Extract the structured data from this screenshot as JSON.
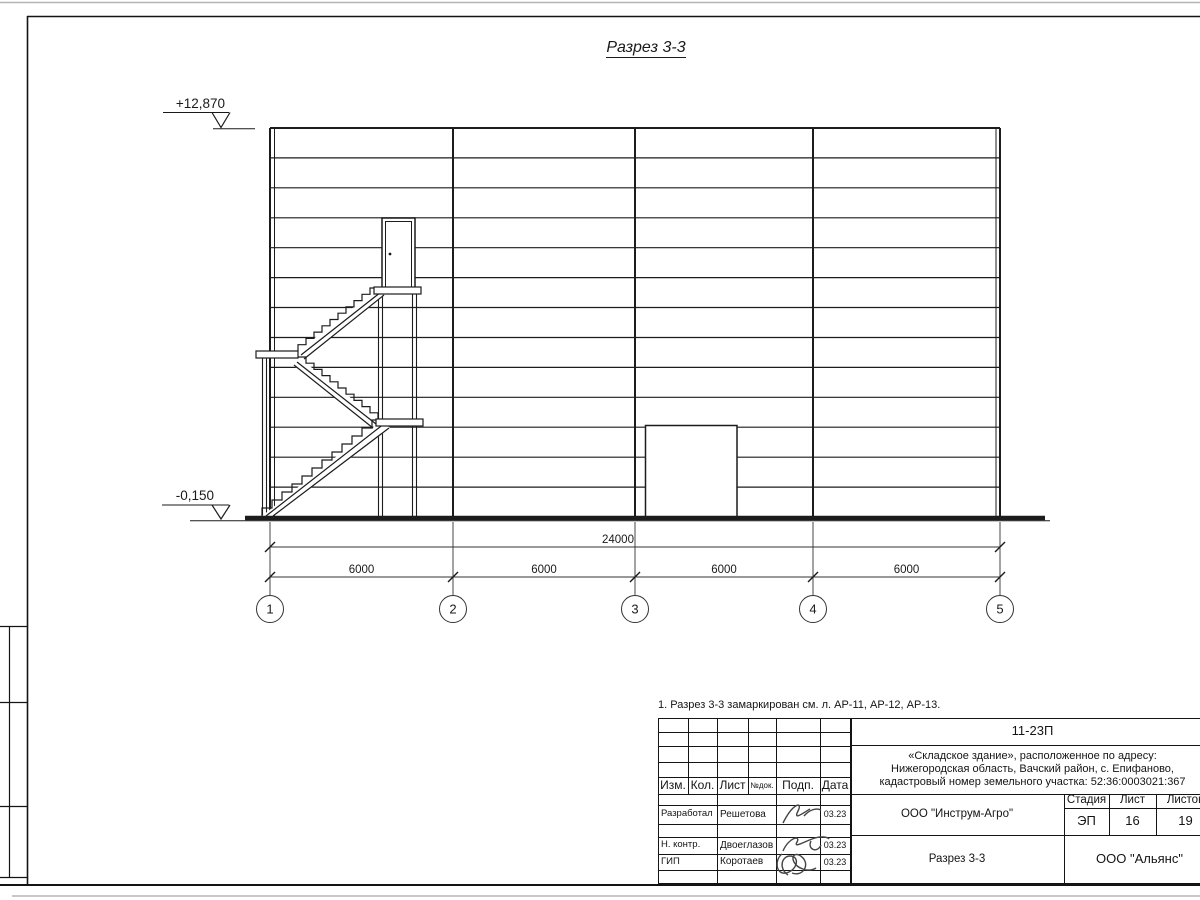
{
  "drawing": {
    "title": "Разрез 3-3",
    "elevation_top": "+12,870",
    "elevation_bottom": "-0,150",
    "dimensions": {
      "total": "24000",
      "bays": [
        "6000",
        "6000",
        "6000",
        "6000"
      ]
    },
    "axes": [
      "1",
      "2",
      "3",
      "4",
      "5"
    ]
  },
  "note": "1. Разрез 3-3 замаркирован см. л. АР-11, АР-12, АР-13.",
  "title_block": {
    "doc_number": "11-23П",
    "project_line1": "«Складское здание», расположенное по адресу:",
    "project_line2": "Нижегородская область, Вачский район, с. Епифаново,",
    "project_line3": "кадастровый номер земельного участка: 52:36:0003021:367",
    "columns": {
      "izm": "Изм.",
      "kol": "Кол.",
      "list": "Лист",
      "ndok": "№док.",
      "podp": "Подп.",
      "data": "Дата"
    },
    "rows": [
      {
        "role": "Разработал",
        "name": "Решетова",
        "date": "03.23"
      },
      {
        "role": "Н. контр.",
        "name": "Двоеглазов",
        "date": "03.23"
      },
      {
        "role": "ГИП",
        "name": "Коротаев",
        "date": "03.23"
      }
    ],
    "org_top": "ООО \"Инструм-Агро\"",
    "stage_label": "Стадия",
    "sheet_label": "Лист",
    "sheets_label": "Листов",
    "stage_value": "ЭП",
    "sheet_value": "16",
    "sheets_value": "19",
    "sheet_title": "Разрез 3-3",
    "org_bottom": "ООО \"Альянс\""
  },
  "colors": {
    "line": "#1a1a1a",
    "edge_gray": "#b5b5b5"
  }
}
